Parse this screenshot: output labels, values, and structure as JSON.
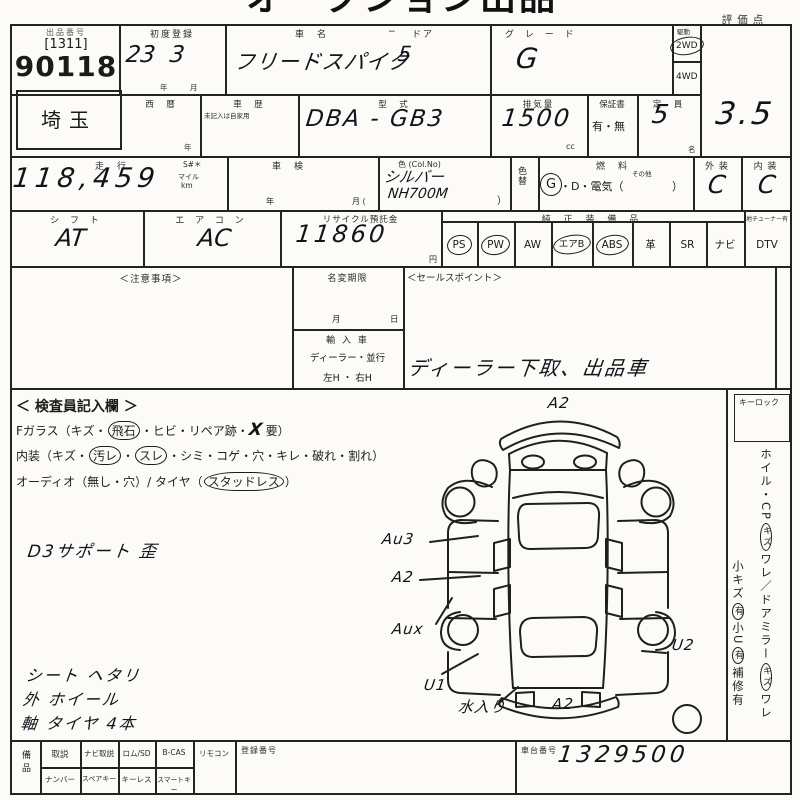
{
  "colors": {
    "paper": "#fcfbf8",
    "ink": "#232323",
    "pen": "#13131c"
  },
  "header": {
    "title": "オークション出品票",
    "score_label": "評価点"
  },
  "row1": {
    "lot": {
      "label": "出品番号",
      "bracket": "[1311]",
      "number": "90118"
    },
    "first_reg": {
      "label": "初度登録",
      "value": "23  3",
      "year": "年",
      "month": "月"
    },
    "car": {
      "label_name": "車　名",
      "dash": "−",
      "label_door": "ドア",
      "name": "フリードスパイク",
      "doors": "5"
    },
    "grade": {
      "label": "グ レ ー ド",
      "value": "G"
    },
    "drive": {
      "label": "駆動",
      "opt1": "2WD",
      "opt2": "4WD",
      "selected": "2WD"
    },
    "score": {
      "value": "3.5"
    }
  },
  "row2": {
    "prefecture": "埼玉",
    "seireki": {
      "label": "西　暦",
      "unit": "年"
    },
    "shareki": {
      "label": "車　歴",
      "note": "未記入は自家用"
    },
    "model": {
      "label": "型　式",
      "value": "DBA - GB3"
    },
    "cc": {
      "label": "排気量",
      "value": "1500",
      "unit": "cc"
    },
    "warranty": {
      "label": "保証書",
      "value": "有・無"
    },
    "capacity": {
      "label": "定　員",
      "value": "5",
      "unit": "名"
    }
  },
  "row3": {
    "mileage": {
      "label": "走　行",
      "s": "S#＊",
      "value": "118,459",
      "mile": "マイル",
      "km": "km"
    },
    "shaken": {
      "label": "車　検",
      "year": "年",
      "month": "月 ("
    },
    "color": {
      "label": "色 (Col.No)",
      "value": "シルバー",
      "code": "NH700M",
      "paren": "）"
    },
    "color_change": "色替",
    "fuel": {
      "label": "燃　料",
      "g": "G",
      "rest": "・D・電気（",
      "other": "その他",
      "close": "）"
    },
    "exterior": {
      "label": "外 装",
      "value": "C"
    },
    "interior": {
      "label": "内 装",
      "value": "C"
    }
  },
  "row4": {
    "shift": {
      "label": "シ フ ト",
      "value": "AT"
    },
    "aircon": {
      "label": "エ ア コ ン",
      "value": "AC"
    },
    "recycle": {
      "label": "リサイクル預託金",
      "value": "11860",
      "unit": "円"
    },
    "equipment": {
      "label": "純 正 装 備 品",
      "tuner": "地チューナー有",
      "items": [
        {
          "label": "PS",
          "circled": true
        },
        {
          "label": "PW",
          "circled": true
        },
        {
          "label": "AW",
          "circled": false
        },
        {
          "label": "エアB",
          "circled": true
        },
        {
          "label": "ABS",
          "circled": true
        },
        {
          "label": "革",
          "circled": false
        },
        {
          "label": "SR",
          "circled": false
        },
        {
          "label": "ナビ",
          "circled": false
        },
        {
          "label": "DTV",
          "circled": false
        }
      ]
    }
  },
  "row5": {
    "caution_label": "＜注意事項＞",
    "name_change": {
      "label": "名変期限",
      "month": "月",
      "day": "日"
    },
    "import": {
      "label": "輸 入 車",
      "line1": "ディーラー・並行",
      "line2": "左H ・ 右H"
    },
    "sales": {
      "label": "＜セールスポイント＞",
      "value": "ディーラー下取、出品車"
    }
  },
  "inspection": {
    "title": "＜ 検査員記入欄 ＞",
    "fglass": {
      "pre": "Fガラス（キズ・",
      "c1": "飛石",
      "mid": "・ヒビ・リペア跡・",
      "x": "X",
      "post": "要）"
    },
    "interior_line": {
      "pre": "内装（キズ・",
      "c1": "汚レ",
      "dot": "・",
      "c2": "スレ",
      "post": "・シミ・コゲ・穴・キレ・破れ・割れ）"
    },
    "audio_line": {
      "pre": "オーディオ（無し・穴）/ タイヤ（",
      "c1": "スタッドレス",
      "post": "）"
    },
    "note": "D3サポート 歪",
    "notes": [
      "シート ヘタリ",
      "外 ホイール",
      "軸 タイヤ 4本"
    ]
  },
  "diagram": {
    "water_note": "水入り",
    "labels": [
      {
        "text": "A2",
        "x": 168,
        "y": 2
      },
      {
        "text": "Au3",
        "x": 2,
        "y": 138
      },
      {
        "text": "A2",
        "x": 12,
        "y": 176
      },
      {
        "text": "Aux",
        "x": 12,
        "y": 228
      },
      {
        "text": "U1",
        "x": 44,
        "y": 284
      },
      {
        "text": "水入り",
        "x": 78,
        "y": 304
      },
      {
        "text": "A2",
        "x": 172,
        "y": 303
      },
      {
        "text": "U2",
        "x": 292,
        "y": 244
      }
    ]
  },
  "right_col": {
    "keylock": "キーロック",
    "v1": {
      "s1": "ホイル・CP",
      "c1": "キズ",
      "s2": "ワレ／ドアミラー",
      "c2": "キズ",
      "s3": "ワレ"
    },
    "v2": {
      "s1": "小キズ",
      "c1": "有",
      "s2": "小U",
      "c2": "有",
      "s3": "補修有"
    }
  },
  "bottom": {
    "side": "備品",
    "r1": [
      "取説",
      "ナビ取説",
      "ロム/SD",
      "B-CAS",
      "リモコン"
    ],
    "r2": [
      "ナンバー",
      "スペアキー",
      "キーレス",
      "スマートキー"
    ],
    "reg_label": "登録番号",
    "chassis": {
      "label": "車台番号",
      "value": "1329500"
    }
  }
}
